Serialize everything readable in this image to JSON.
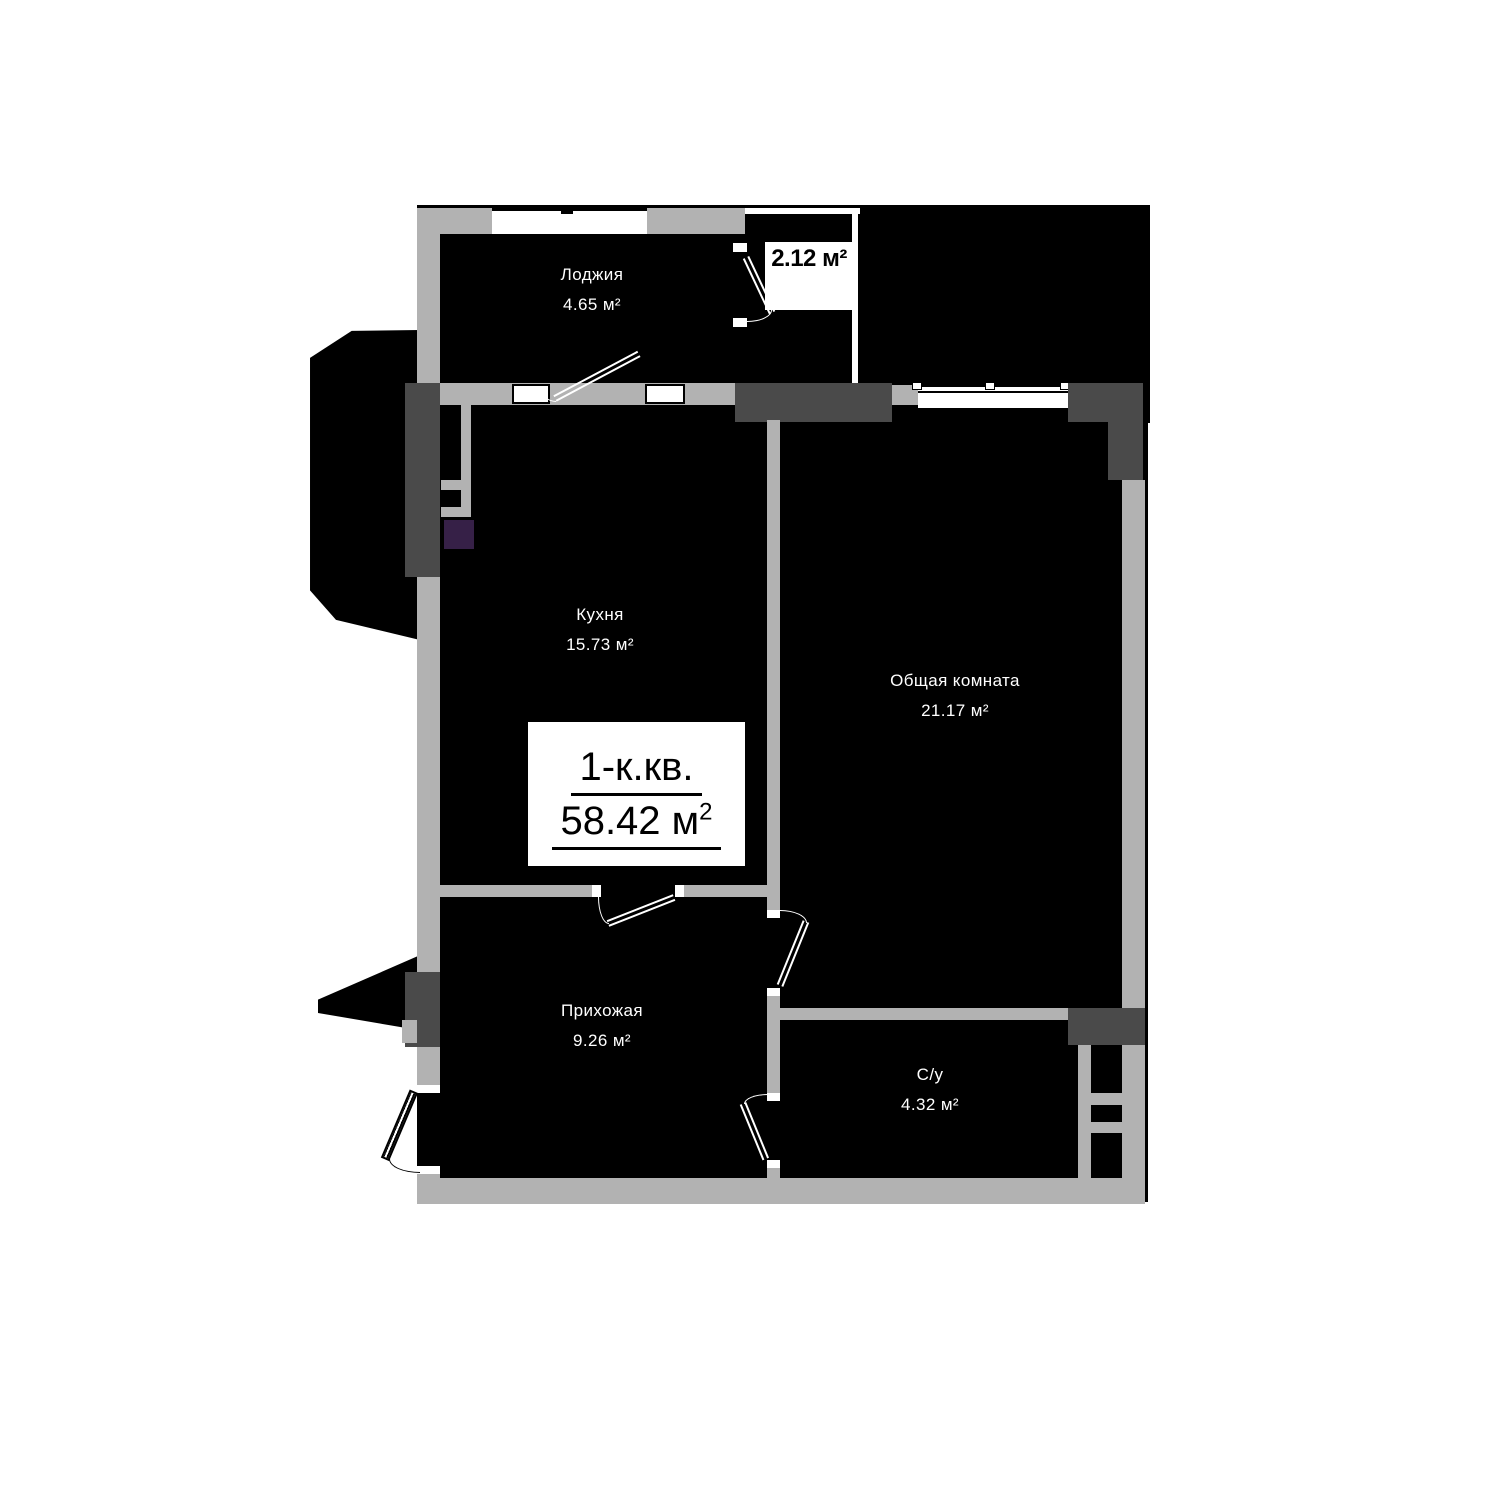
{
  "floor_plan": {
    "info_box": {
      "unit_type": "1-к.кв.",
      "total_area": "58.42 м",
      "total_area_sup": "2"
    },
    "rooms": {
      "loggia": {
        "name": "Лоджия",
        "area": "4.65 м²"
      },
      "storage": {
        "area": "2.12 м²"
      },
      "kitchen": {
        "name": "Кухня",
        "area": "15.73 м²"
      },
      "living_room": {
        "name": "Общая комната",
        "area": "21.17 м²"
      },
      "hallway": {
        "name": "Прихожая",
        "area": "9.26 м²"
      },
      "bathroom": {
        "name": "С/у",
        "area": "4.32 м²"
      }
    },
    "colors": {
      "wall_light": "#b2b2b2",
      "wall_dark": "#4a4a4a",
      "interior": "#000000",
      "shaft": "#362047",
      "background": "#ffffff"
    }
  }
}
